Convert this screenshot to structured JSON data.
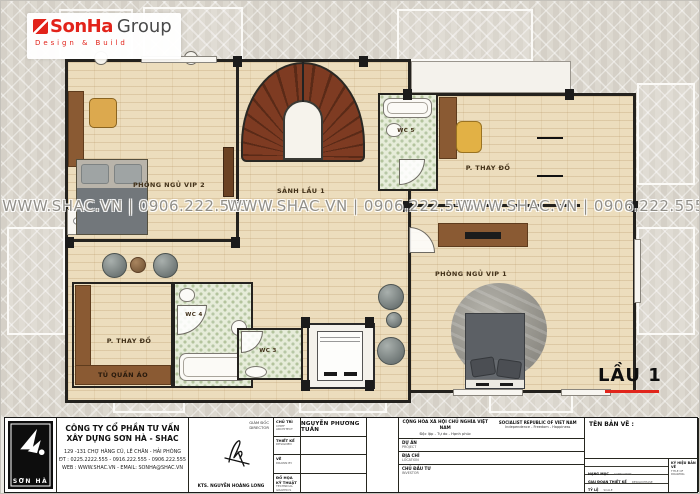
{
  "brand": {
    "name": "SonHa",
    "suffix": "Group",
    "tagline": "Design & Build"
  },
  "watermark": {
    "text": "WWW.SHAC.VN | 0906.222.555"
  },
  "floor_label": "LẦU 1",
  "rooms": {
    "bedroom_vip2": "PHÒNG NGỦ VIP 2",
    "hall_floor1": "SẢNH LẦU 1",
    "wc5": "WC 5",
    "dressing_right": "P. THAY ĐỒ",
    "bedroom_vip1": "PHÒNG NGỦ VIP 1",
    "dressing_left": "P. THAY ĐỒ",
    "wardrobe": "TỦ QUẦN ÁO",
    "wc4": "WC 4",
    "wc3": "WC 3"
  },
  "title_block": {
    "logo_text": "SƠN HÀ",
    "company": {
      "name_line1": "CÔNG TY CỔ PHẦN TƯ VẤN",
      "name_line2": "XÂY DỰNG SƠN HÀ - SHAC",
      "address": "129 -131 CHỢ HÀNG CŨ, LÊ CHÂN - HẢI PHÒNG",
      "phone": "ĐT : 0225.2222.555 - 0916.222.555 - 0906.222.555",
      "web": "WEB : WWW.SHAC.VN - EMAIL: SONHA@SHAC.VN"
    },
    "director": {
      "label_vn": "GIÁM ĐỐC",
      "label_en": "DIRECTOR",
      "name": "KTS. NGUYỄN HOÀNG LONG"
    },
    "staff_rows": [
      {
        "label_vn": "CHỦ TRÌ",
        "label_en": "CHIEF ARCHITECT",
        "value": "NGUYỄN PHƯƠNG TUẤN"
      },
      {
        "label_vn": "THIẾT KẾ",
        "label_en": "DESIGNED",
        "value": ""
      },
      {
        "label_vn": "VẼ",
        "label_en": "DRAWN BY",
        "value": ""
      },
      {
        "label_vn": "ĐỒ HỌA KỸ THUẬT",
        "label_en": "TECHNICAL GRAPHICS",
        "value": ""
      }
    ],
    "republic": {
      "vn_line1": "CỘNG HÒA XÃ HỘI CHỦ NGHĨA VIỆT NAM",
      "vn_line2": "Độc lập - Tự do - Hạnh phúc",
      "en_line1": "SOCIALIST REPUBLIC OF VIET NAM",
      "en_line2": "Independence - Freedom - Happiness",
      "rows": [
        {
          "label_vn": "DỰ ÁN",
          "label_en": "PROJECT"
        },
        {
          "label_vn": "ĐỊA CHỈ",
          "label_en": "LOCATION"
        },
        {
          "label_vn": "CHỦ ĐẦU TƯ",
          "label_en": "INVESTOR"
        }
      ]
    },
    "drawing": {
      "title_label": "TÊN BẢN VẼ :",
      "rows": [
        {
          "label_vn": "HẠNG MỤC",
          "label_en": "CATEGORIES"
        },
        {
          "label_vn": "GIAI ĐOẠN THIẾT KẾ",
          "label_en": "DESIGN PHASE"
        },
        {
          "label_vn": "TỶ LỆ",
          "label_en": "SCALE"
        },
        {
          "label_vn": "HOÀN THÀNH",
          "label_en": "DATE"
        }
      ],
      "code_label_vn": "KÝ HIỆU BẢN VẼ",
      "code_label_en": "TITLE OF DRAWING"
    }
  },
  "colors": {
    "accent_red": "#e2231a",
    "wood_floor": "#ecddbd",
    "stair_wood": "#7c3a22",
    "wc_tile": "#e6ecd9",
    "wall": "#24221e",
    "watermark": "#7d7a73"
  }
}
